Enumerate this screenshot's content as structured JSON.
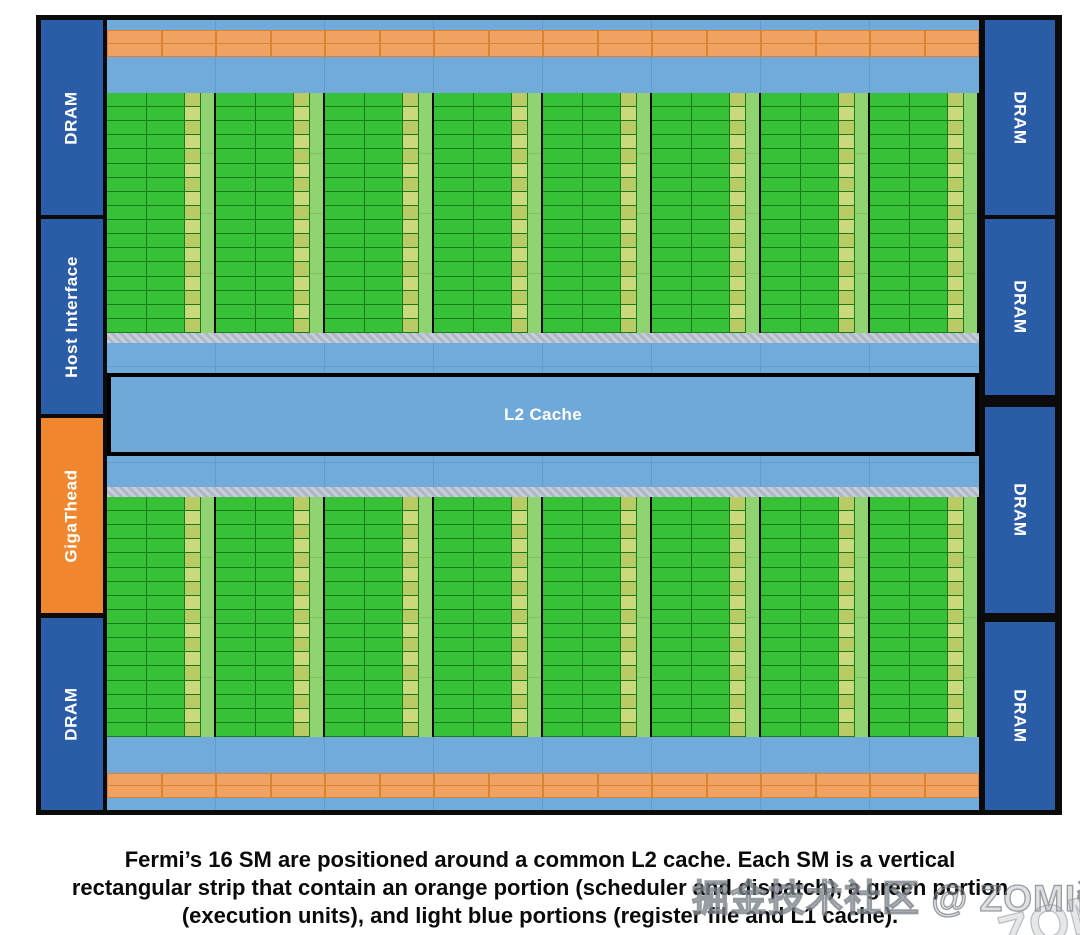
{
  "diagram": {
    "left_column": {
      "blocks": [
        {
          "label": "DRAM",
          "kind": "dram"
        },
        {
          "label": "Host Interface",
          "kind": "dram"
        },
        {
          "label": "GigaThead",
          "kind": "giga"
        },
        {
          "label": "DRAM",
          "kind": "dram"
        }
      ]
    },
    "right_column": {
      "blocks": [
        {
          "label": "DRAM"
        },
        {
          "label": "DRAM"
        },
        {
          "label": "DRAM"
        },
        {
          "label": "DRAM"
        }
      ]
    },
    "core": {
      "l2_label": "L2 Cache",
      "sm_total": 16,
      "sm_per_half": 8,
      "exec_rows_per_sm": 17,
      "orange_cells_per_row": 16,
      "orange_rows": 2
    },
    "colors": {
      "frame_black": "#0b0b0b",
      "dram_blue": "#2b5ca7",
      "giga_orange": "#f0872f",
      "band_blue": "#70abdb",
      "band_blue_line": "#5f9dcb",
      "l2_blue": "#6fa9da",
      "orange_cell": "#f0a263",
      "orange_line": "#d9822f",
      "green_cell": "#36c136",
      "green_line": "#1a7a1a",
      "lime_a": "#b8cb65",
      "lime_b": "#cbd97d",
      "light_green": "#8fd470",
      "light_green_line": "#7cc45e",
      "hatch_a": "#c7ced9",
      "hatch_b": "#aeb7c7",
      "label_text": "#ffffff"
    }
  },
  "caption": {
    "lines": [
      "Fermi’s 16 SM are positioned around a common L2 cache. Each SM is a vertical",
      "rectangular strip that contain an orange portion (scheduler and dispatch), a green portion",
      "(execution units), and light blue portions (register file and L1 cache)."
    ]
  },
  "watermark": {
    "text": "掘金技术社区 @ ZOMI酱",
    "fragment": "ZOMI酱"
  }
}
